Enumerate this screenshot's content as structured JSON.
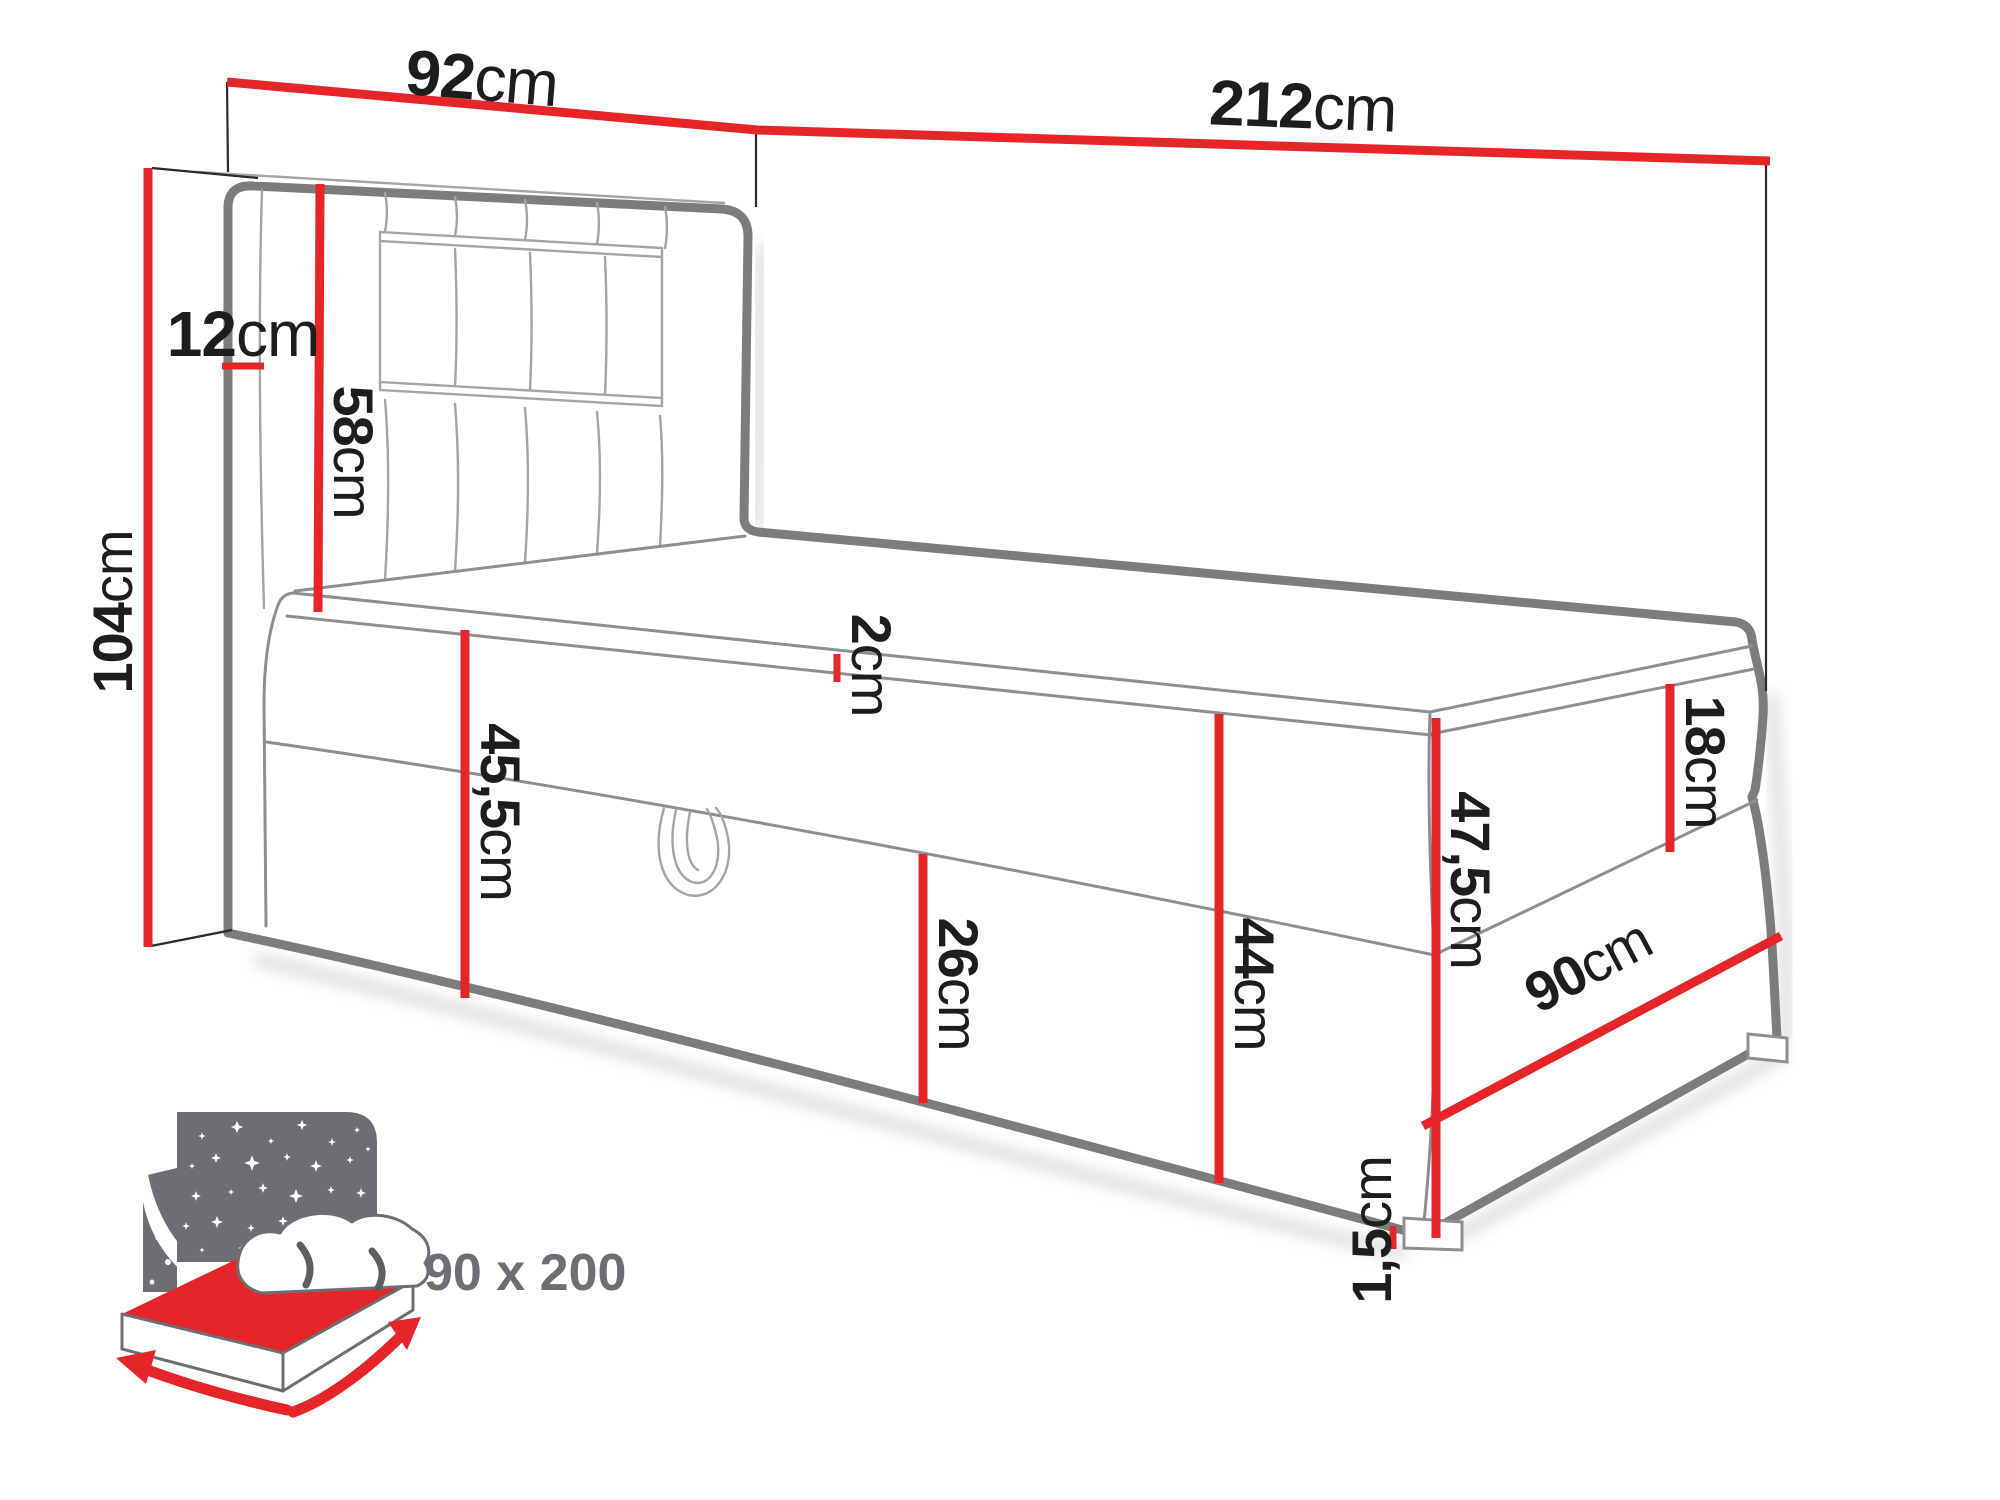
{
  "colors": {
    "accent_red": "#e52528",
    "drawing_gray": "#7c7c7e",
    "thin_gray": "#8e8e90",
    "text_black": "#1d1d1b",
    "icon_gray": "#6d6e71",
    "background": "#ffffff"
  },
  "dimensions": {
    "headboard_width": {
      "value": "92",
      "unit": "cm"
    },
    "total_length": {
      "value": "212",
      "unit": "cm"
    },
    "headboard_depth": {
      "value": "12",
      "unit": "cm"
    },
    "headboard_height": {
      "value": "104",
      "unit": "cm"
    },
    "headboard_panel": {
      "value": "58",
      "unit": "cm"
    },
    "topper_height": {
      "value": "2",
      "unit": "cm"
    },
    "base_height": {
      "value": "45,5",
      "unit": "cm"
    },
    "storage_box_height": {
      "value": "26",
      "unit": "cm"
    },
    "boxes_height": {
      "value": "44",
      "unit": "cm"
    },
    "mattress_height": {
      "value": "18",
      "unit": "cm"
    },
    "side_total_height": {
      "value": "47,5",
      "unit": "cm"
    },
    "foot_width": {
      "value": "90",
      "unit": "cm"
    },
    "feet_height": {
      "value": "1,5",
      "unit": "cm"
    }
  },
  "icon_badge": {
    "size_label": "90 x 200"
  }
}
